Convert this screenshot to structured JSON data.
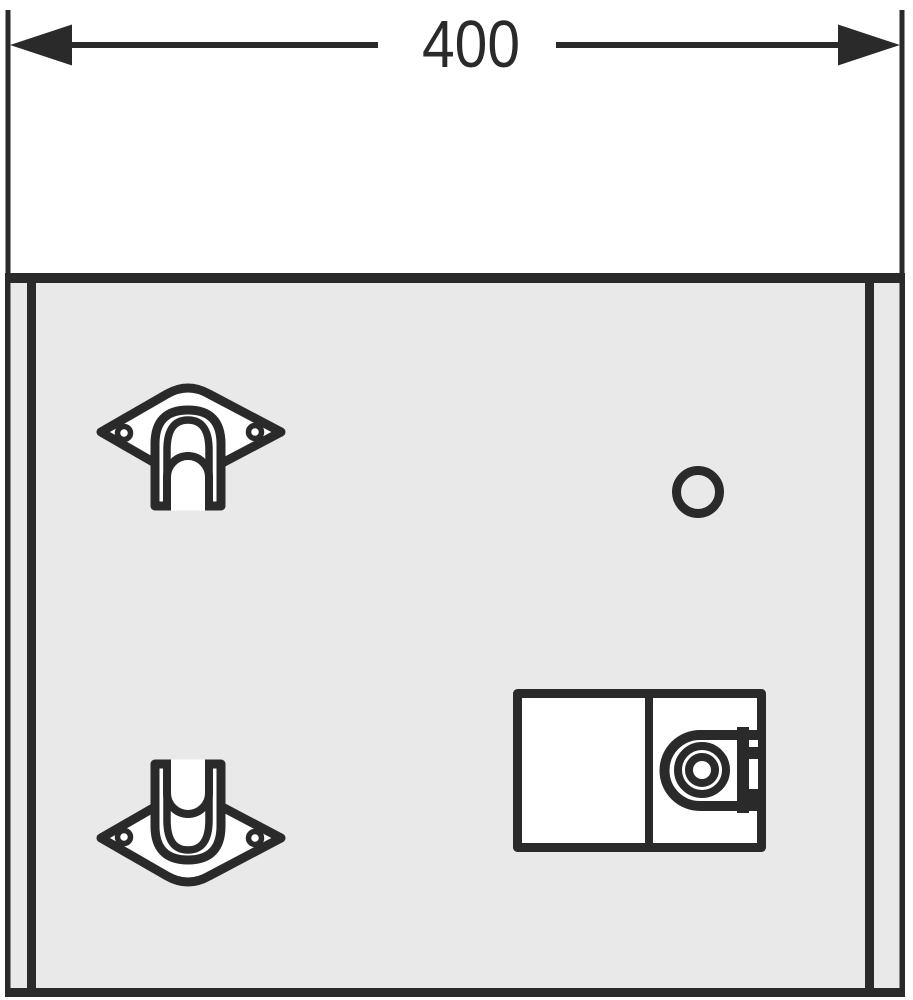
{
  "dimension": {
    "label": "400"
  },
  "colors": {
    "line": "#2a2a2a",
    "panel": "#e9e9e9",
    "part": "#ffffff",
    "background": "#ffffff"
  },
  "parts": [
    {
      "name": "dimension-annotation",
      "kind": "linear-dimension",
      "value": "400"
    },
    {
      "name": "cabinet-body",
      "kind": "rear-panel"
    },
    {
      "name": "mounting-bracket-top",
      "kind": "wall-mounting-bracket"
    },
    {
      "name": "mounting-bracket-bottom",
      "kind": "wall-mounting-bracket-mirrored"
    },
    {
      "name": "fixing-hole",
      "kind": "circular-hole"
    },
    {
      "name": "service-box",
      "kind": "two-compartment-box-with-cam-lock"
    }
  ]
}
